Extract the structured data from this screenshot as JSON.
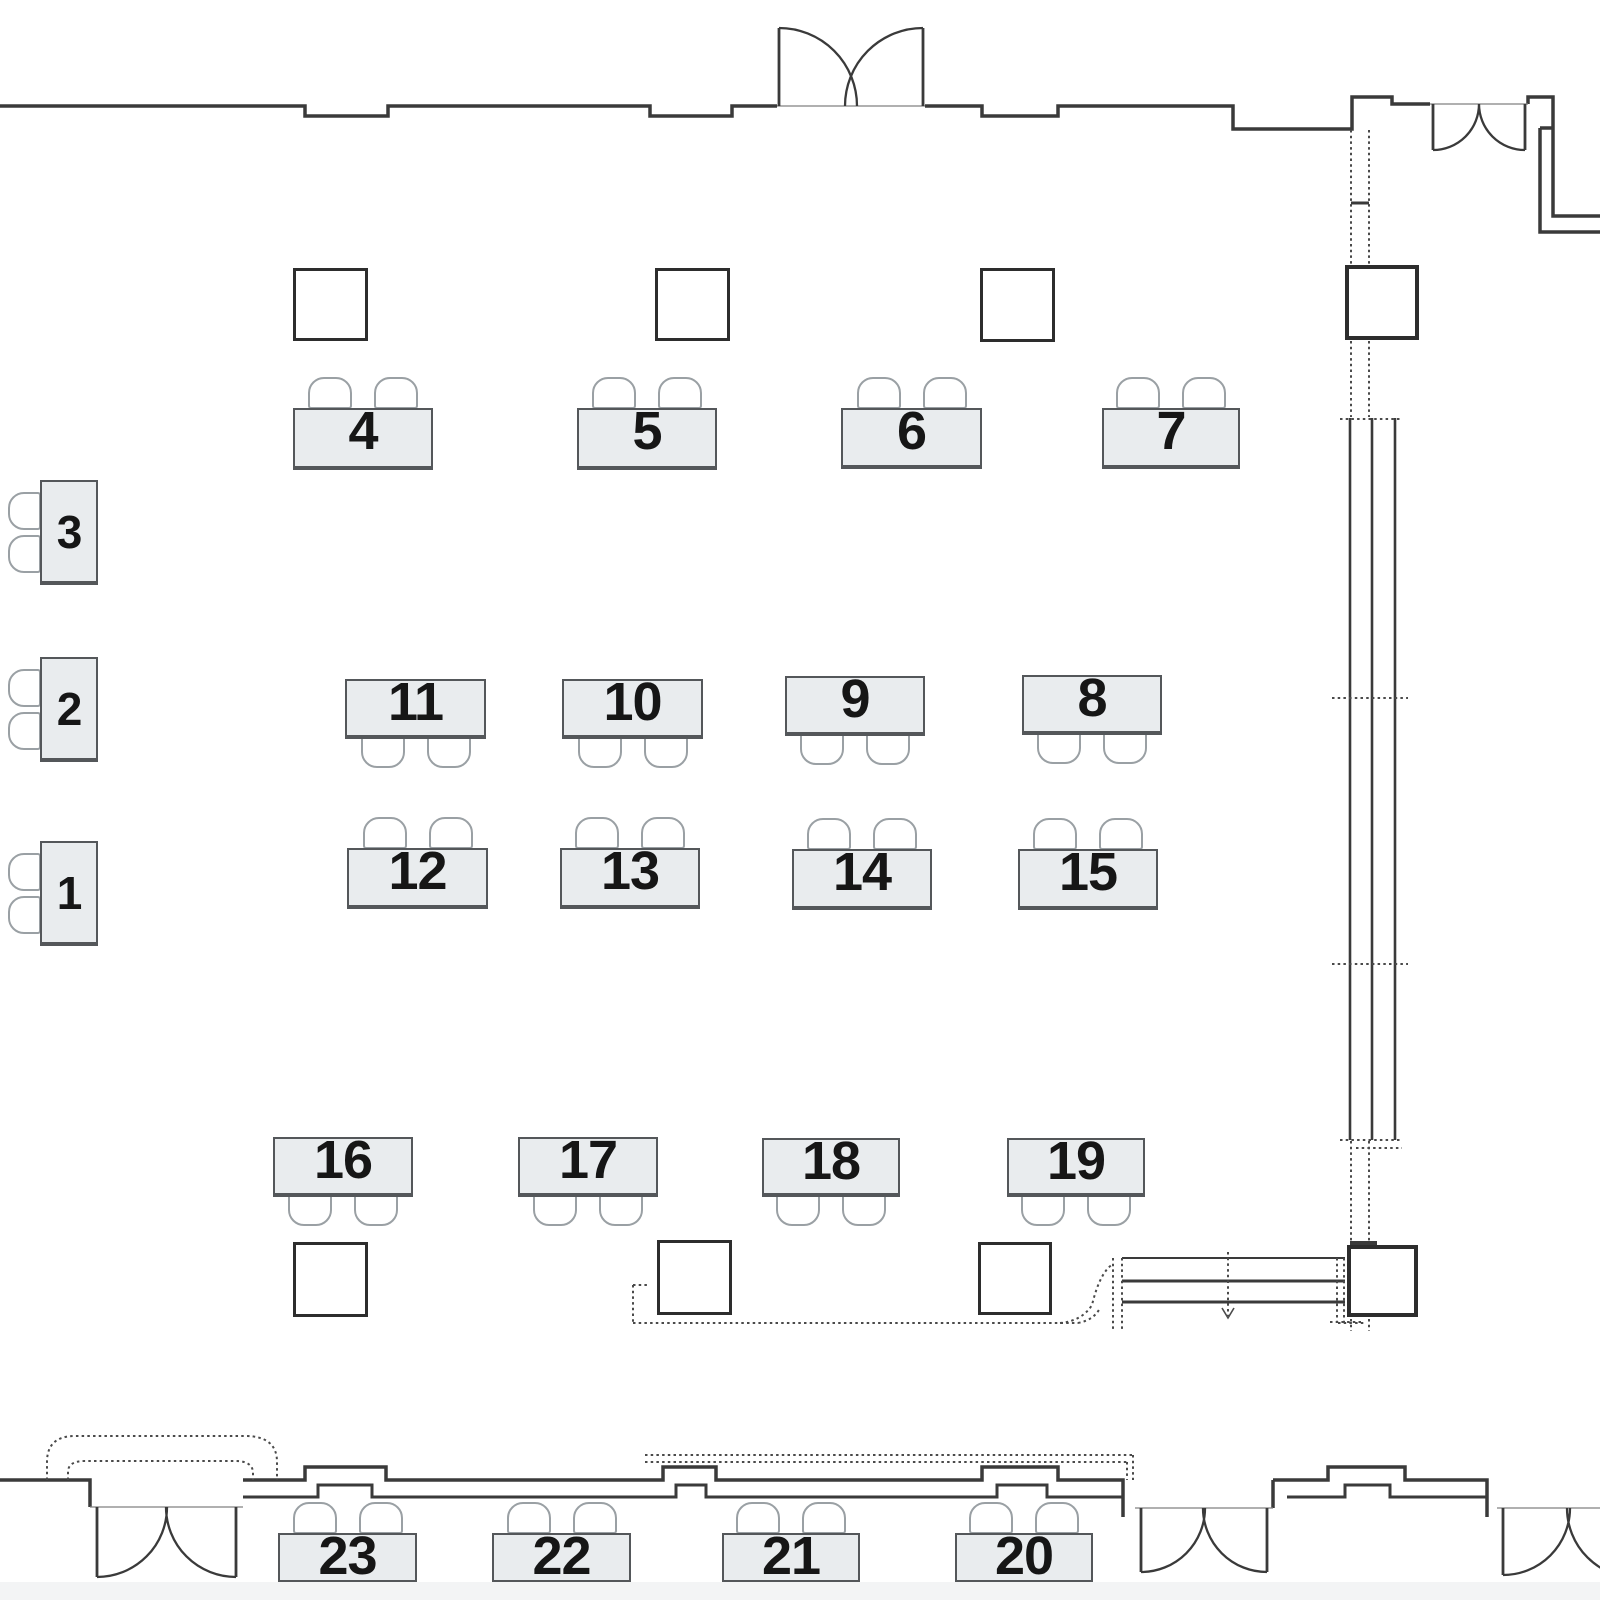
{
  "page": {
    "title": "Room floor plan with numbered tables",
    "background": "#ffffff"
  },
  "colors": {
    "table_fill": "#e9ecee",
    "table_border": "#54575a",
    "chair_stroke": "#9aa0a4",
    "wall": "#3a3a3a",
    "dotted": "#4a4a4a",
    "door_line": "#808080",
    "label_text": "#161616",
    "square_border": "#2d2d2d",
    "bottom_strip": "#f3f4f5"
  },
  "tables": [
    {
      "label": "1",
      "x": 40,
      "y": 841,
      "w": 58,
      "h": 103,
      "chairs": "left"
    },
    {
      "label": "2",
      "x": 40,
      "y": 657,
      "w": 58,
      "h": 103,
      "chairs": "left"
    },
    {
      "label": "3",
      "x": 40,
      "y": 480,
      "w": 58,
      "h": 103,
      "chairs": "left"
    },
    {
      "label": "4",
      "x": 293,
      "y": 408,
      "w": 140,
      "h": 60,
      "chairs": "above"
    },
    {
      "label": "5",
      "x": 577,
      "y": 408,
      "w": 140,
      "h": 60,
      "chairs": "above"
    },
    {
      "label": "6",
      "x": 841,
      "y": 408,
      "w": 141,
      "h": 59,
      "chairs": "above"
    },
    {
      "label": "7",
      "x": 1102,
      "y": 408,
      "w": 138,
      "h": 59,
      "chairs": "above"
    },
    {
      "label": "8",
      "x": 1022,
      "y": 675,
      "w": 140,
      "h": 58,
      "chairs": "below"
    },
    {
      "label": "9",
      "x": 785,
      "y": 676,
      "w": 140,
      "h": 58,
      "chairs": "below"
    },
    {
      "label": "10",
      "x": 562,
      "y": 679,
      "w": 141,
      "h": 58,
      "chairs": "below"
    },
    {
      "label": "11",
      "x": 345,
      "y": 679,
      "w": 141,
      "h": 58,
      "chairs": "below"
    },
    {
      "label": "12",
      "x": 347,
      "y": 848,
      "w": 141,
      "h": 59,
      "chairs": "above"
    },
    {
      "label": "13",
      "x": 560,
      "y": 848,
      "w": 140,
      "h": 59,
      "chairs": "above"
    },
    {
      "label": "14",
      "x": 792,
      "y": 849,
      "w": 140,
      "h": 59,
      "chairs": "above"
    },
    {
      "label": "15",
      "x": 1018,
      "y": 849,
      "w": 140,
      "h": 59,
      "chairs": "above"
    },
    {
      "label": "16",
      "x": 273,
      "y": 1137,
      "w": 140,
      "h": 58,
      "chairs": "below"
    },
    {
      "label": "17",
      "x": 518,
      "y": 1137,
      "w": 140,
      "h": 58,
      "chairs": "below"
    },
    {
      "label": "18",
      "x": 762,
      "y": 1138,
      "w": 138,
      "h": 57,
      "chairs": "below"
    },
    {
      "label": "19",
      "x": 1007,
      "y": 1138,
      "w": 138,
      "h": 57,
      "chairs": "below"
    },
    {
      "label": "20",
      "x": 955,
      "y": 1533,
      "w": 138,
      "h": 49,
      "chairs": "above"
    },
    {
      "label": "21",
      "x": 722,
      "y": 1533,
      "w": 138,
      "h": 49,
      "chairs": "above"
    },
    {
      "label": "22",
      "x": 492,
      "y": 1533,
      "w": 139,
      "h": 49,
      "chairs": "above"
    },
    {
      "label": "23",
      "x": 278,
      "y": 1533,
      "w": 139,
      "h": 49,
      "chairs": "above"
    }
  ],
  "squares": [
    {
      "x": 293,
      "y": 268,
      "w": 75,
      "h": 73,
      "kind": "floor"
    },
    {
      "x": 655,
      "y": 268,
      "w": 75,
      "h": 73,
      "kind": "floor"
    },
    {
      "x": 980,
      "y": 268,
      "w": 75,
      "h": 74,
      "kind": "floor"
    },
    {
      "x": 293,
      "y": 1242,
      "w": 75,
      "h": 75,
      "kind": "floor"
    },
    {
      "x": 657,
      "y": 1240,
      "w": 75,
      "h": 75,
      "kind": "floor"
    },
    {
      "x": 978,
      "y": 1242,
      "w": 74,
      "h": 73,
      "kind": "floor"
    },
    {
      "x": 1345,
      "y": 265,
      "w": 74,
      "h": 75,
      "kind": "post"
    },
    {
      "x": 1347,
      "y": 1245,
      "w": 71,
      "h": 72,
      "kind": "post"
    }
  ]
}
